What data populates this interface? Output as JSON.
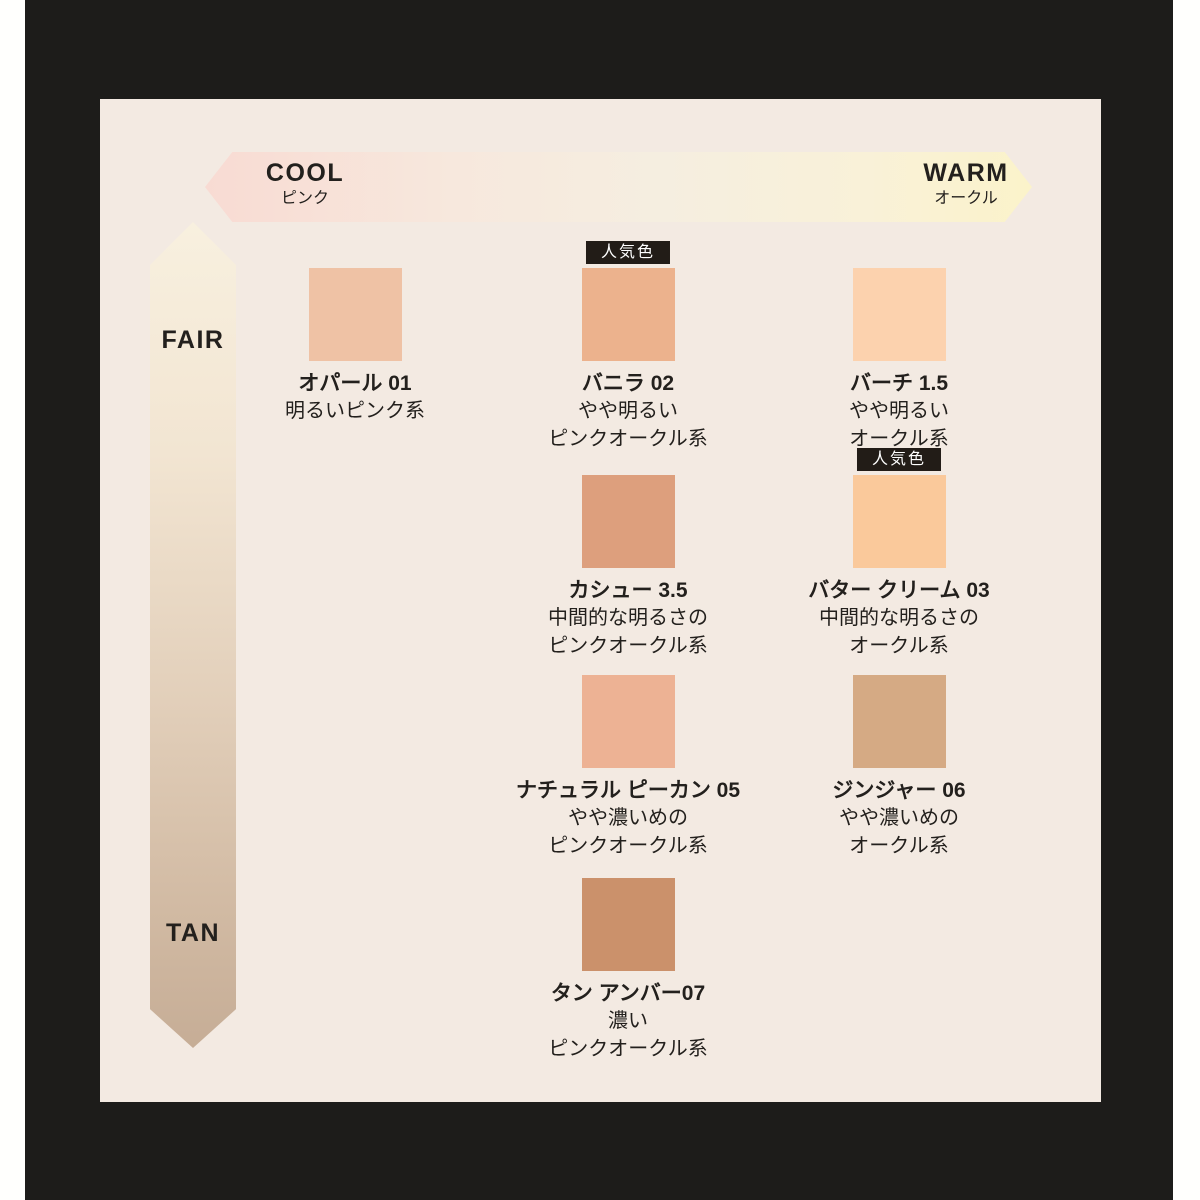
{
  "colors": {
    "frame_black": "#1d1c1a",
    "panel_cream": "#f3eae2",
    "text_dark": "#23201d",
    "badge_bg": "#221c17",
    "badge_text": "#ffffff",
    "harrow_pink": "#f8dbd3",
    "harrow_yellow": "#fbf3ca",
    "varrow_top": "#f8f0df",
    "varrow_bottom": "#c6ad96"
  },
  "axes": {
    "horizontal": {
      "left_label": "COOL",
      "left_sub": "ピンク",
      "right_label": "WARM",
      "right_sub": "オークル"
    },
    "vertical": {
      "top_label": "FAIR",
      "bottom_label": "TAN"
    }
  },
  "badge_label": "人気色",
  "shades": [
    {
      "name": "オパール 01",
      "desc1": "明るいピンク系",
      "desc2": "",
      "color": "#efc2a5",
      "popular": false
    },
    {
      "name": "バニラ 02",
      "desc1": "やや明るい",
      "desc2": "ピンクオークル系",
      "color": "#ecb28d",
      "popular": true
    },
    {
      "name": "バーチ 1.5",
      "desc1": "やや明るい",
      "desc2": "オークル系",
      "color": "#fcd2ae",
      "popular": false
    },
    {
      "name": "カシュー 3.5",
      "desc1": "中間的な明るさの",
      "desc2": "ピンクオークル系",
      "color": "#dd9f7d",
      "popular": false
    },
    {
      "name": "バター クリーム 03",
      "desc1": "中間的な明るさの",
      "desc2": "オークル系",
      "color": "#fac99b",
      "popular": true
    },
    {
      "name": "ナチュラル ピーカン 05",
      "desc1": "やや濃いめの",
      "desc2": "ピンクオークル系",
      "color": "#edb294",
      "popular": false
    },
    {
      "name": "ジンジャー 06",
      "desc1": "やや濃いめの",
      "desc2": "オークル系",
      "color": "#d5aa84",
      "popular": false
    },
    {
      "name": "タン アンバー07",
      "desc1": "濃い",
      "desc2": "ピンクオークル系",
      "color": "#cb916b",
      "popular": false
    }
  ]
}
